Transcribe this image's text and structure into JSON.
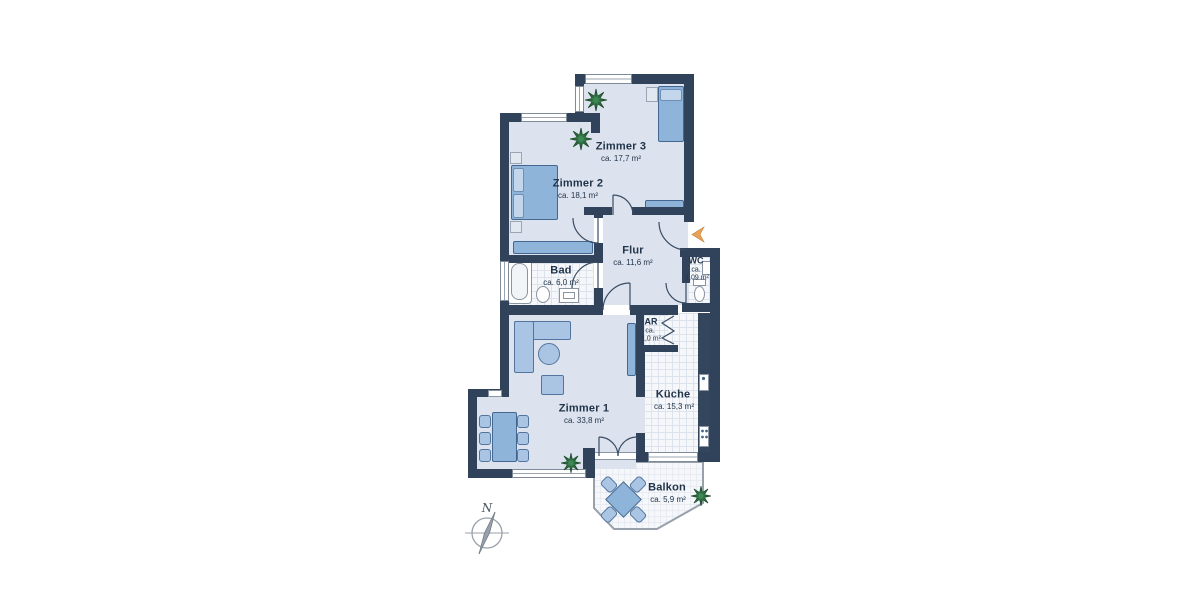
{
  "rooms": {
    "zimmer1": {
      "name": "Zimmer 1",
      "area": "ca. 33,8 m²"
    },
    "zimmer2": {
      "name": "Zimmer 2",
      "area": "ca. 18,1 m²"
    },
    "zimmer3": {
      "name": "Zimmer 3",
      "area": "ca. 17,7 m²"
    },
    "flur": {
      "name": "Flur",
      "area": "ca. 11,6 m²"
    },
    "bad": {
      "name": "Bad",
      "area": "ca. 6,0 m²"
    },
    "wc": {
      "name": "WC",
      "area_prefix": "ca.",
      "area_value": "1,09 m²"
    },
    "ar": {
      "name": "AR",
      "area_prefix": "ca.",
      "area_value": "1,0 m²"
    },
    "kueche": {
      "name": "Küche",
      "area": "ca. 15,3 m²"
    },
    "balkon": {
      "name": "Balkon",
      "area": "ca. 5,9 m²"
    }
  },
  "compass": {
    "north_label": "N"
  },
  "colors": {
    "wall": "#31435a",
    "floor": "#dce3ee",
    "tile_floor": "#f5f7fa",
    "furniture": "#8fb4da",
    "entry_arrow": "#e7a259",
    "plant": "#2c6b3f"
  }
}
